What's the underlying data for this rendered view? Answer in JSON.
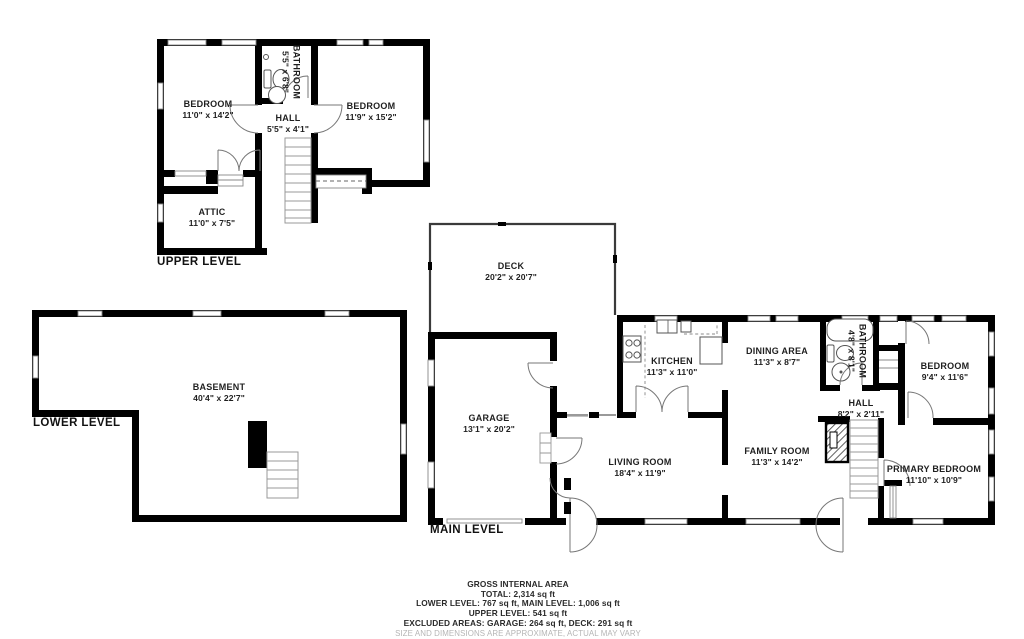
{
  "title": "Residential floor plan",
  "levels": {
    "upper": {
      "label": "UPPER LEVEL",
      "rooms": {
        "bedroom_left": {
          "name": "BEDROOM",
          "dims": "11'0\" x 14'2\""
        },
        "bathroom": {
          "name": "BATHROOM",
          "dims": "5'5\" x 6'8\""
        },
        "bedroom_right": {
          "name": "BEDROOM",
          "dims": "11'9\" x 15'2\""
        },
        "hall": {
          "name": "HALL",
          "dims": "5'5\" x 4'1\""
        },
        "attic": {
          "name": "ATTIC",
          "dims": "11'0\" x 7'5\""
        }
      }
    },
    "lower": {
      "label": "LOWER LEVEL",
      "rooms": {
        "basement": {
          "name": "BASEMENT",
          "dims": "40'4\" x 22'7\""
        }
      }
    },
    "main": {
      "label": "MAIN LEVEL",
      "rooms": {
        "deck": {
          "name": "DECK",
          "dims": "20'2\" x 20'7\""
        },
        "kitchen": {
          "name": "KITCHEN",
          "dims": "11'3\" x 11'0\""
        },
        "dining_area": {
          "name": "DINING AREA",
          "dims": "11'3\" x 8'7\""
        },
        "bathroom": {
          "name": "BATHROOM",
          "dims": "4'8\" x 8'1\""
        },
        "bedroom": {
          "name": "BEDROOM",
          "dims": "9'4\" x 11'6\""
        },
        "garage": {
          "name": "GARAGE",
          "dims": "13'1\" x 20'2\""
        },
        "living_room": {
          "name": "LIVING ROOM",
          "dims": "18'4\" x 11'9\""
        },
        "family_room": {
          "name": "FAMILY ROOM",
          "dims": "11'3\" x 14'2\""
        },
        "hall": {
          "name": "HALL",
          "dims": "8'2\" x 2'11\""
        },
        "primary_bedroom": {
          "name": "PRIMARY BEDROOM",
          "dims": "11'10\" x 10'9\""
        }
      }
    }
  },
  "footer": {
    "heading": "GROSS INTERNAL AREA",
    "total": "TOTAL: 2,314 sq ft",
    "lower_main": "LOWER LEVEL: 767 sq ft, MAIN LEVEL: 1,006 sq ft",
    "upper": "UPPER LEVEL: 541 sq ft",
    "excluded": "EXCLUDED AREAS: GARAGE: 264 sq ft, DECK: 291 sq ft",
    "disclaimer": "SIZE AND DIMENSIONS ARE APPROXIMATE, ACTUAL MAY VARY"
  },
  "colors": {
    "wall": "#000000",
    "thin_line": "#888888",
    "label_text": "#1f1f1f",
    "disclaimer_text": "#b5b5b5",
    "background": "#ffffff"
  }
}
